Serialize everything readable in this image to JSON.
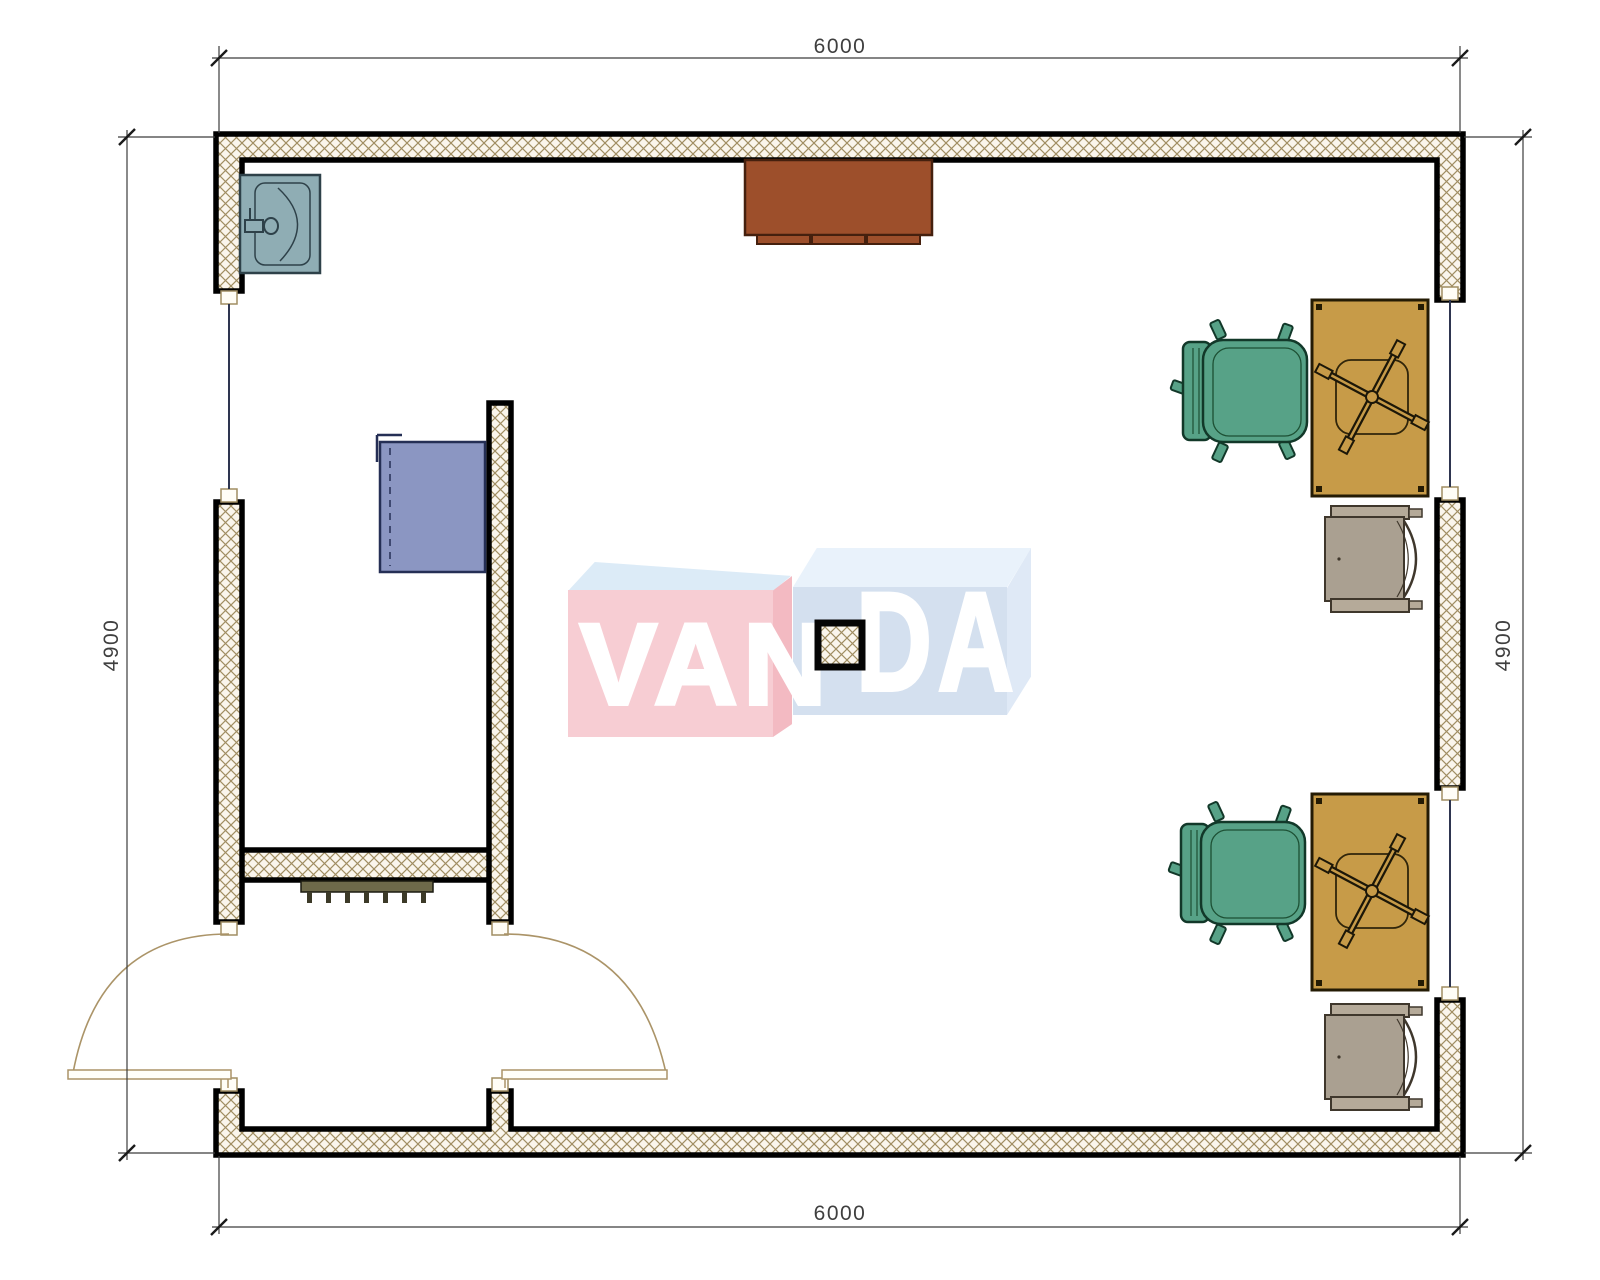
{
  "page": {
    "title": "VANDA office floor plan"
  },
  "dimensions": {
    "top": "6000",
    "bottom": "6000",
    "left": "4900",
    "right": "4900"
  },
  "watermark": {
    "left_text": "VAN",
    "right_text": "DA"
  },
  "icons": {
    "sink": "sink-symbol",
    "counter": "counter-cabinet-symbol",
    "blue_cabinet": "wall-cabinet-symbol",
    "office_chair": "office-chair-symbol",
    "desk": "desk-with-chair-cross-symbol",
    "printer_cabinet": "printer-cabinet-symbol",
    "radiator": "radiator-symbol",
    "double_door": "double-swing-door-symbol",
    "column": "column-symbol",
    "window": "window-glazing-line"
  },
  "colors": {
    "wall_hatch_line": "#a08d62",
    "wall_hatch_bg": "#faf5ec",
    "wall_edge": "#000000",
    "sink": "#8fadb4",
    "counter": "#9d4f2b",
    "blue_cabinet": "#8b96c2",
    "chair_green": "#57a287",
    "desk_tan": "#c79b48",
    "printer_gray": "#aaa091",
    "radiator_olive": "#6e6a4a",
    "door_arc": "#ab9468",
    "glazing": "#2e3550",
    "dimension": "#3f3f3f",
    "watermark_pink": "#f7cdd3",
    "watermark_blue": "#d4e0ef"
  }
}
